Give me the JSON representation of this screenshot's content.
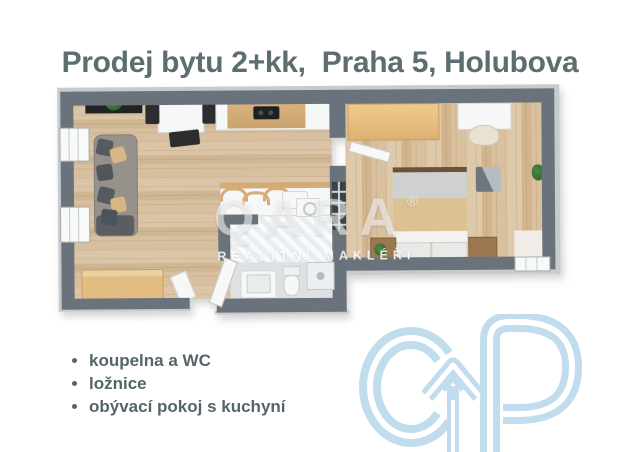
{
  "title": "Prodej bytu 2+kk,  Praha 5, Holubova",
  "watermark": {
    "brand": "QARA",
    "registered": "®",
    "tagline": "REALITNÍ MAKLÉŘI"
  },
  "features": {
    "items": [
      "koupelna a WC",
      "ložnice",
      "obývací pokoj s kuchyní"
    ]
  },
  "logo": {
    "name": "cp-arrow-monogram",
    "color": "#c1dcec"
  },
  "palette": {
    "title_text": "#5c6e70",
    "feature_text": "#54666a",
    "wall_gray": "#6a737b",
    "floor_wood": "#d6bd9e",
    "bathroom_floor": "#dde1e4",
    "furniture_tan": "#e3bc81",
    "watermark_white": "rgba(255,255,255,0.55)"
  }
}
